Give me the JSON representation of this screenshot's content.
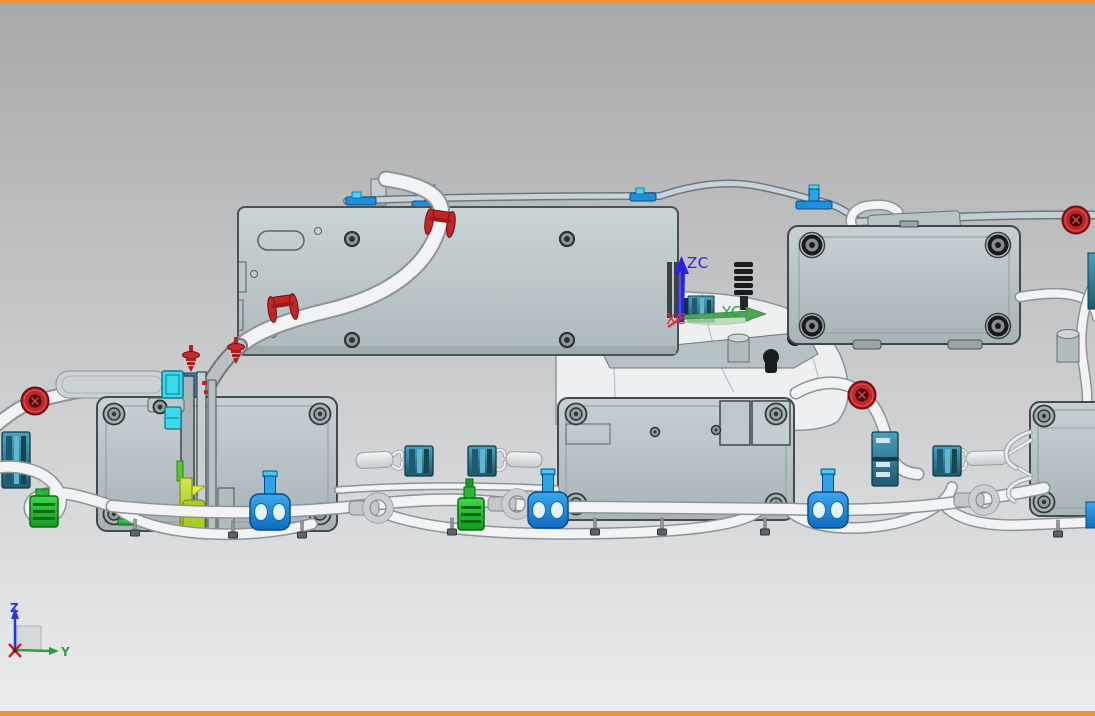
{
  "viewport": {
    "background_top": "#A8AAAC",
    "background_bottom": "#EAEBED",
    "frame_color": "#EF9233"
  },
  "wcs": {
    "z_label": "ZC",
    "y_label": "YC",
    "x_label": "XC",
    "z_color": "#2822E6",
    "y_color": "#2F9E42",
    "x_color": "#D83038"
  },
  "view_axes": {
    "z_label": "Z",
    "y_label": "Y",
    "z_color": "#2436E8",
    "y_color": "#2F9E42",
    "origin_color": "#C22428"
  },
  "palette": {
    "plate_gray": "#C3CED2",
    "tube_white": "#F1F3F5",
    "tube_gray": "#BCC0C2",
    "connector_teal": "#2E7F99",
    "connector_cyan": "#3ADAEC",
    "clip_red": "#C22428",
    "clamp_blue": "#1E8FDC",
    "connector_green": "#2BC436",
    "highlight_chartreuse": "#C3DC3A",
    "rail_blue_clip": "#2AA3E8"
  }
}
